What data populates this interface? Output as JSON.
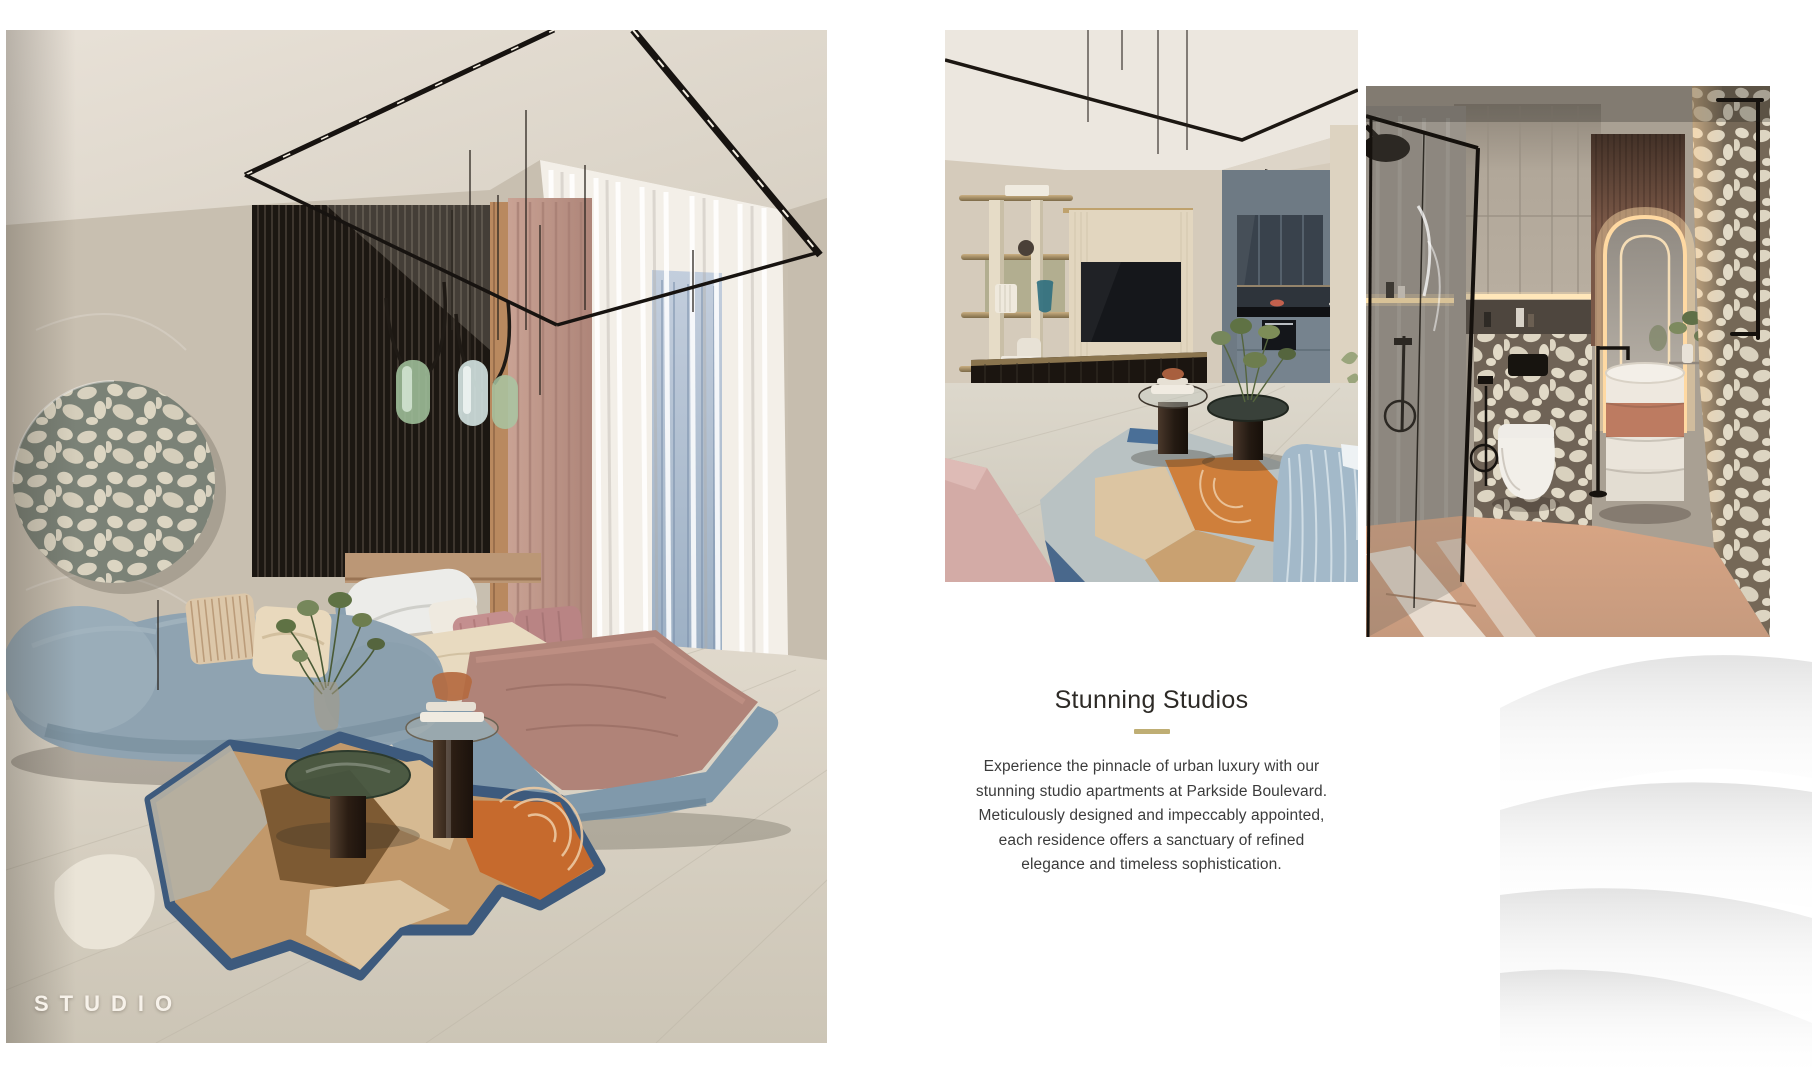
{
  "page": {
    "background": "#ffffff",
    "accent": "#bfae74"
  },
  "left_photo": {
    "name": "studio-bedroom-photo",
    "overlay_label": "STUDIO"
  },
  "top_photos": [
    {
      "name": "living-room-photo"
    },
    {
      "name": "bathroom-photo"
    }
  ],
  "content": {
    "heading": "Stunning Studios",
    "paragraph_lines": [
      "Experience the pinnacle of urban luxury with our",
      "stunning studio apartments at Parkside Boulevard.",
      "Meticulously designed and impeccably appointed,",
      "each residence offers a sanctuary of refined",
      "elegance and timeless sophistication."
    ]
  }
}
